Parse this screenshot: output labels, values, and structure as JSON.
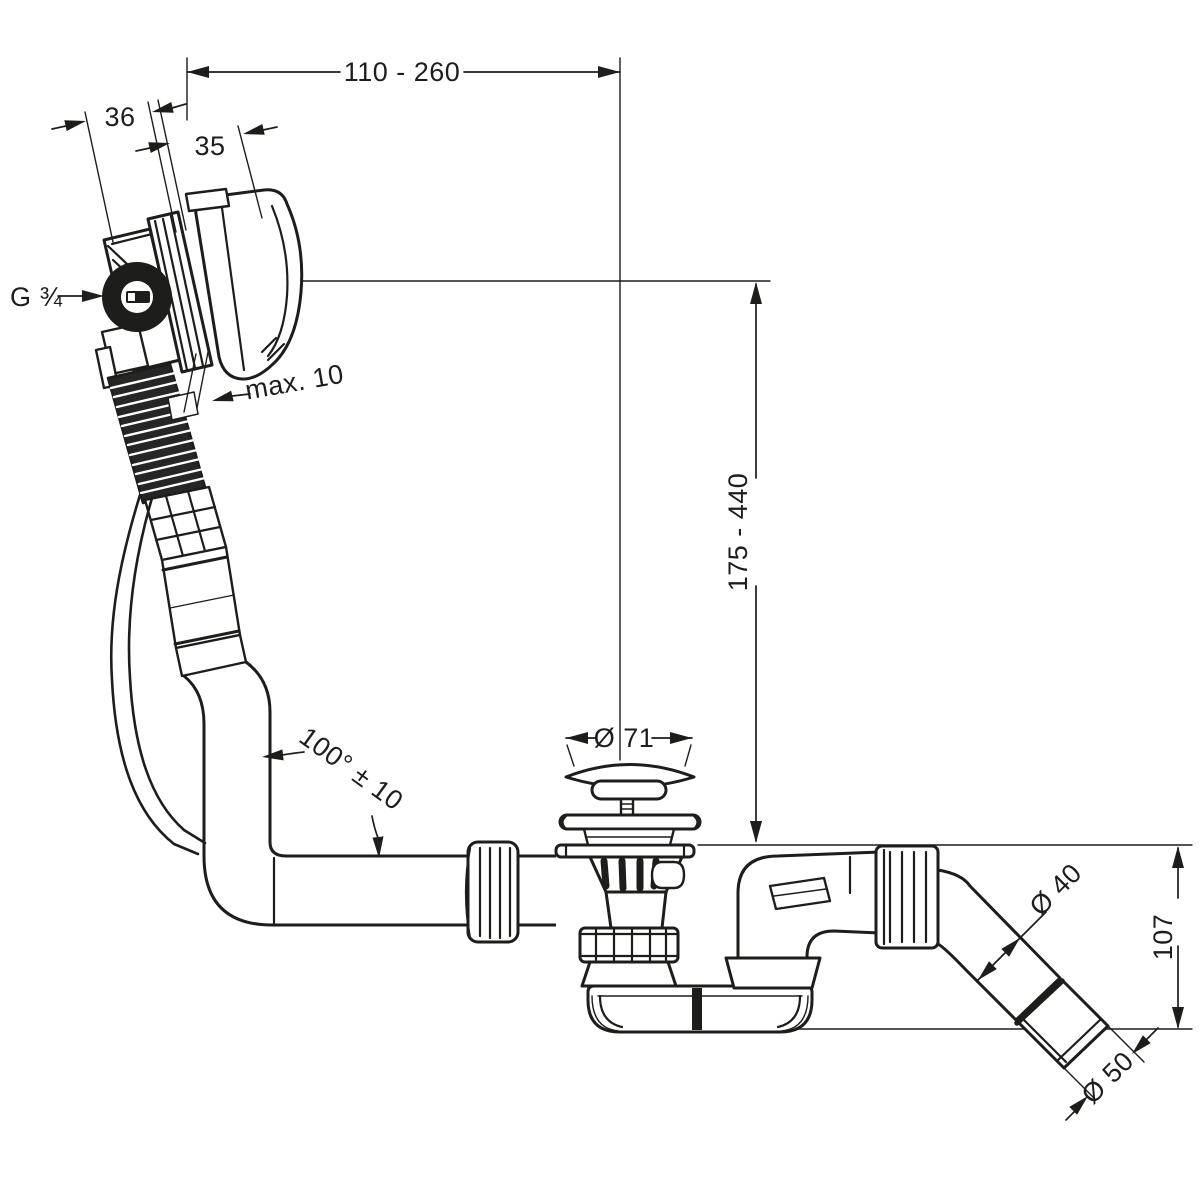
{
  "colors": {
    "ink": "#1d1d1b",
    "background": "#ffffff"
  },
  "dimensions": {
    "width_range": "110 - 260",
    "body_depth": "36",
    "rosette_depth": "35",
    "thread": "G ¾",
    "wall_max": "max. 10",
    "height_range": "175 - 440",
    "plug_diameter": "Ø 71",
    "hose_angle": "100° ± 10",
    "pipe_diameter": "Ø 40",
    "outlet_height": "107",
    "outlet_diameter": "Ø 50"
  }
}
